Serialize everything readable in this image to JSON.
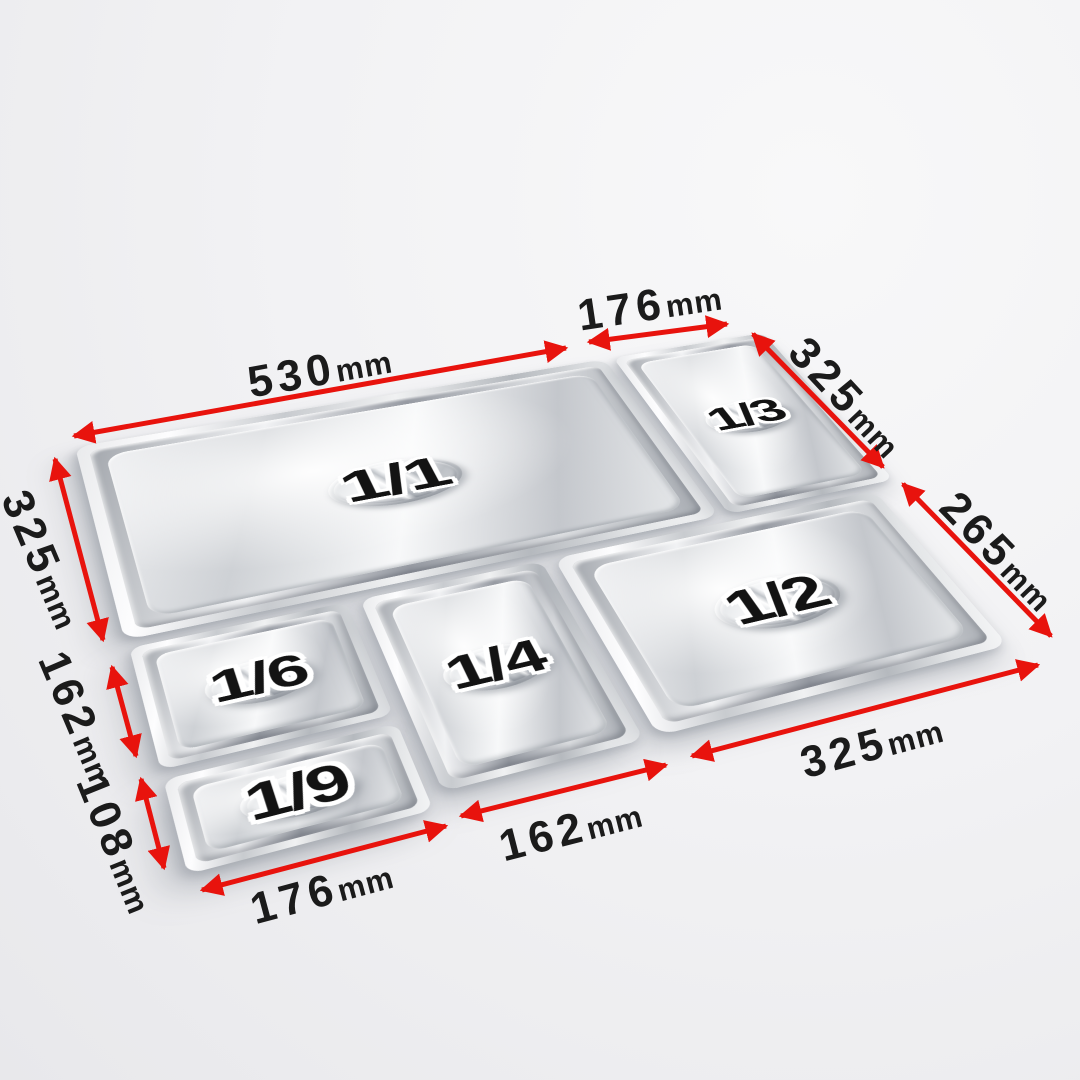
{
  "image": {
    "description": "Perspective diagram of six stainless steel gastronorm pan lids laid edge to edge, annotated with red double-headed dimension arrows",
    "background_color": "#f2f2f4",
    "arrow_color": "#e8130d",
    "dimension_text_color": "#1b1b1b"
  },
  "pans": [
    {
      "label": "1/1"
    },
    {
      "label": "1/3"
    },
    {
      "label": "1/6"
    },
    {
      "label": "1/4"
    },
    {
      "label": "1/9"
    },
    {
      "label": "1/2"
    }
  ],
  "dimensions": [
    {
      "value": "530",
      "unit": "mm",
      "for": "1/1 width, top edge"
    },
    {
      "value": "176",
      "unit": "mm",
      "for": "1/3 width, top edge"
    },
    {
      "value": "325",
      "unit": "mm",
      "for": "1/3 depth, right edge"
    },
    {
      "value": "265",
      "unit": "mm",
      "for": "1/2 depth, right edge"
    },
    {
      "value": "325",
      "unit": "mm",
      "for": "1/1 depth, left edge"
    },
    {
      "value": "162",
      "unit": "mm",
      "for": "1/6 depth, left edge"
    },
    {
      "value": "108",
      "unit": "mm",
      "for": "1/9 depth, left edge"
    },
    {
      "value": "176",
      "unit": "mm",
      "for": "1/9 width, bottom edge"
    },
    {
      "value": "162",
      "unit": "mm",
      "for": "1/4 width, bottom edge"
    },
    {
      "value": "325",
      "unit": "mm",
      "for": "1/2 width, bottom edge"
    }
  ]
}
